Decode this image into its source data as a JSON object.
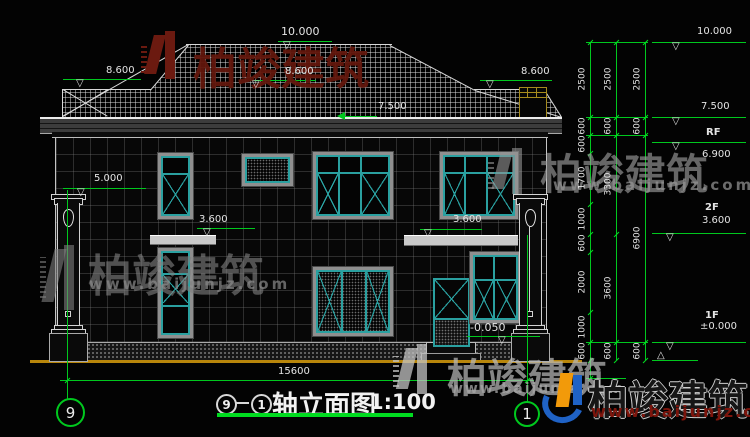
{
  "wm": {
    "brand": "柏竣建筑",
    "url": "www.baijunjz.com"
  },
  "roof": {
    "ridge": "10.000",
    "left": "8.600",
    "mid": "8.600",
    "right": "8.600",
    "eave": "7.500"
  },
  "fac": {
    "pillar": "5.000",
    "belt_left": "3.600",
    "belt_right": "3.600",
    "entrance": "-0.050"
  },
  "lv": {
    "l10": "10.000",
    "l75": "7.500",
    "rf_name": "RF",
    "rf": "6.900",
    "f2_name": "2F",
    "f2": "3.600",
    "f1_name": "1F",
    "f1": "±0.000"
  },
  "ch": {
    "c1": [
      "2500",
      "600",
      "600",
      "1700",
      "1000",
      "600",
      "2000",
      "1000",
      "600"
    ],
    "c2": [
      "2500",
      "600",
      "3300",
      "3600",
      "600"
    ],
    "c3": [
      "2500",
      "600",
      "6900",
      "600"
    ]
  },
  "bt": {
    "total": "15600",
    "ax9": "9",
    "ax1": "1",
    "t9": "9",
    "t1": "1",
    "title": "轴立面图",
    "scale": "1:100"
  }
}
